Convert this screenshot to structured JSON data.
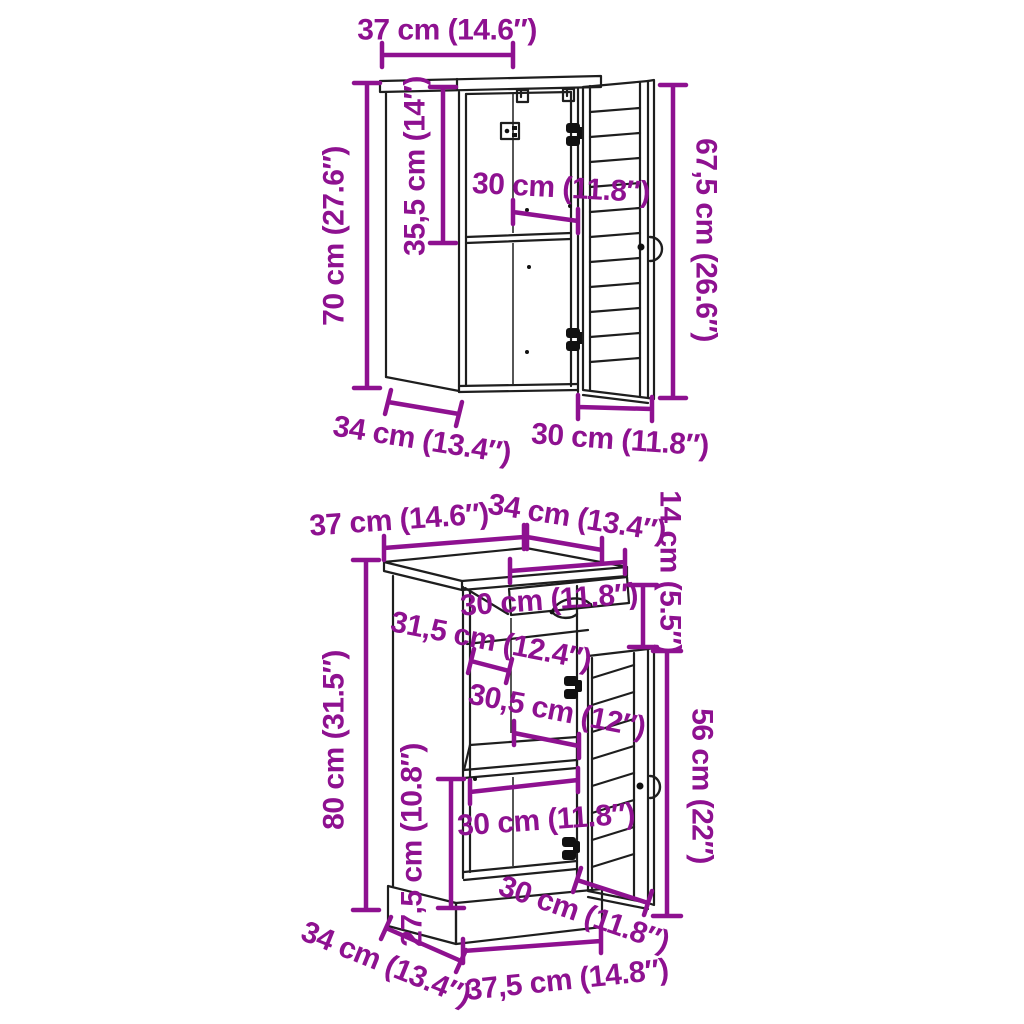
{
  "colors": {
    "dimension": "#8E1190",
    "outline": "#1E1E1E",
    "background": "#FFFFFF"
  },
  "wall_cabinet": {
    "dims": {
      "top_width": "37 cm (14.6″)",
      "interior_height": "35,5 cm (14″)",
      "interior_width": "30 cm (11.8″)",
      "height": "70 cm (27.6″)",
      "door_height": "67,5 cm (26.6″)",
      "depth": "34 cm (13.4″)",
      "door_width": "30 cm (11.8″)"
    }
  },
  "floor_cabinet": {
    "dims": {
      "top_width": "37 cm (14.6″)",
      "top_depth": "34 cm (13.4″)",
      "drawer_height": "14 cm (5.5″)",
      "drawer_width": "30 cm (11.8″)",
      "interior_depth": "31,5 cm (12.4″)",
      "interior_width_upper": "30,5 cm (12″)",
      "height": "80 cm (31.5″)",
      "door_height": "56 cm (22″)",
      "interior_height_lower": "27,5 cm (10.8″)",
      "shelf_width": "30 cm (11.8″)",
      "door_width": "30 cm (11.8″)",
      "base_depth": "34 cm (13.4″)",
      "base_width": "37,5 cm (14.8″)"
    }
  }
}
